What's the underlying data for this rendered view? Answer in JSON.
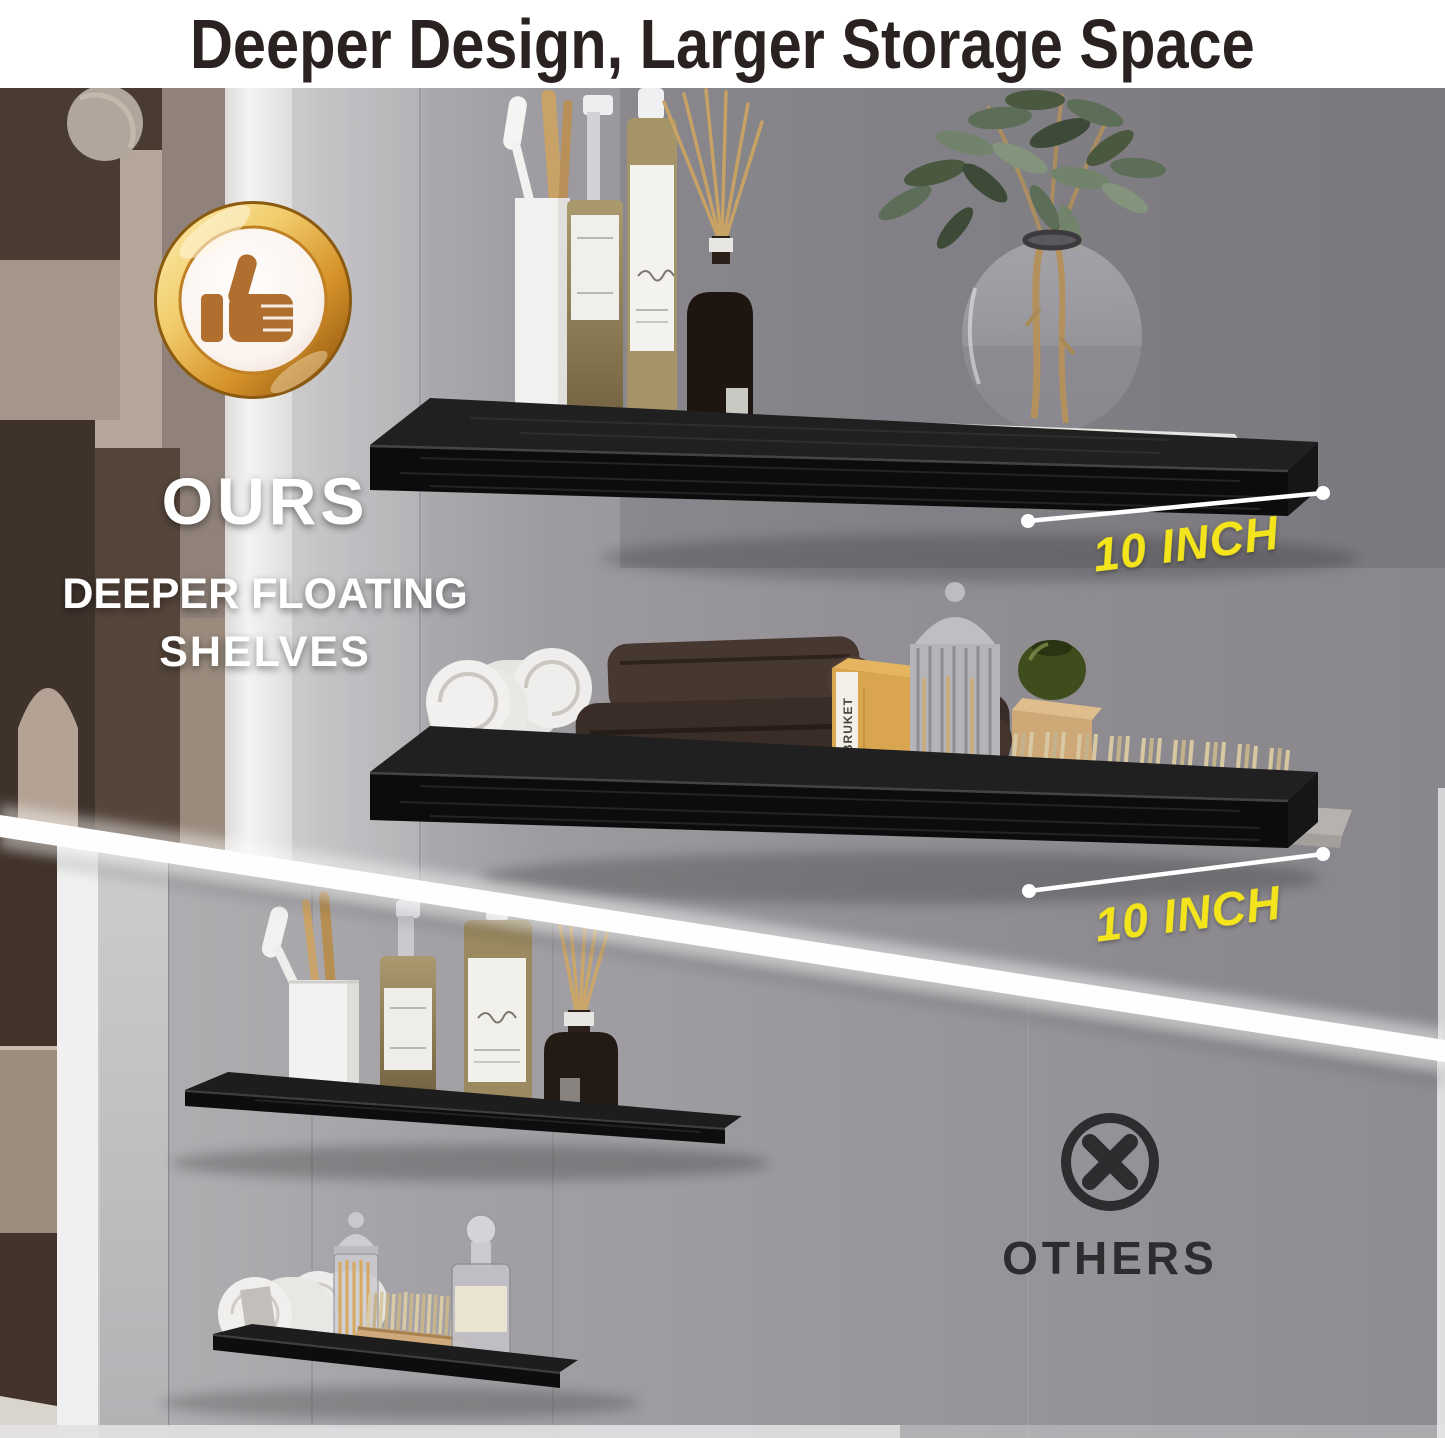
{
  "title": "Deeper Design, Larger Storage Space",
  "ours_section": {
    "badge_icon": "thumbs-up-icon",
    "heading": "OURS",
    "subheading_line1": "DEEPER FLOATING",
    "subheading_line2": "SHELVES",
    "shelf_depth_labels": [
      "10 INCH",
      "10 INCH"
    ]
  },
  "others_section": {
    "icon": "cross-circle-icon",
    "heading": "OTHERS"
  },
  "product_props": {
    "kraft_box_brand": "L:A BRUKET"
  },
  "colors": {
    "accent_yellow": "#f3e41a",
    "badge_gold": "#d9952c",
    "badge_thumb_brown": "#b06f2e",
    "shelf_black": "#121212",
    "wall_gray": "#98969a",
    "divider_white": "#fefefe",
    "others_text": "#2e2c2f",
    "title_color": "#292220"
  }
}
